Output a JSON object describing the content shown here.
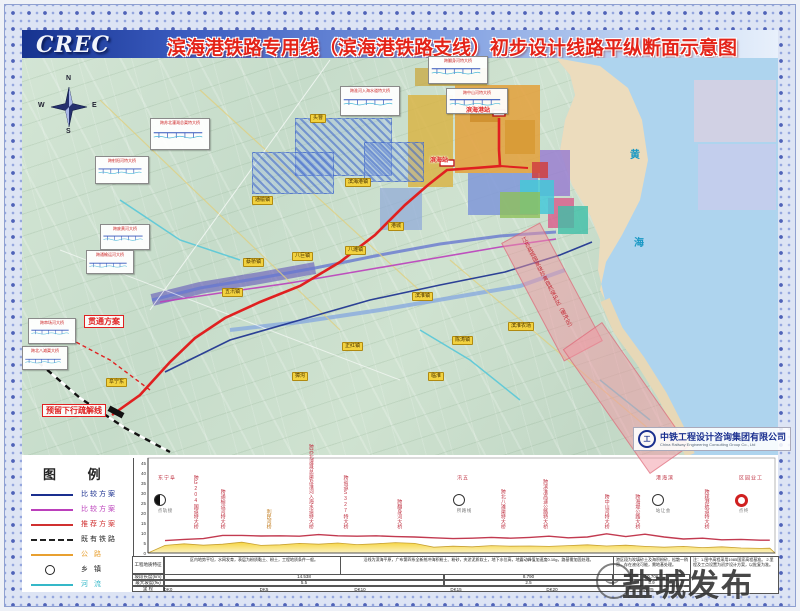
{
  "title_bar": {
    "logo": "CREC",
    "title": "滨海港铁路专用线（滨海港铁路支线）初步设计线路平纵断面示意图"
  },
  "map": {
    "sea_chars": [
      {
        "t": "黄",
        "x": 630,
        "y": 146
      },
      {
        "t": "海",
        "x": 634,
        "y": 234
      }
    ],
    "compass": {
      "n": "N",
      "w": "W",
      "e": "E",
      "s": "S"
    },
    "scheme_labels": [
      {
        "t": "贯通方案",
        "x": 84,
        "y": 315
      },
      {
        "t": "预留下行疏解线",
        "x": 42,
        "y": 404
      }
    ],
    "station_labels": [
      {
        "t": "滨海站",
        "x": 430,
        "y": 155
      },
      {
        "t": "滨海港站",
        "x": 466,
        "y": 105
      }
    ],
    "town_labels": [
      {
        "t": "头罾",
        "x": 310,
        "y": 114
      },
      {
        "t": "滨海港镇",
        "x": 345,
        "y": 178
      },
      {
        "t": "港城",
        "x": 388,
        "y": 222
      },
      {
        "t": "通榆镇",
        "x": 252,
        "y": 196
      },
      {
        "t": "八巨镇",
        "x": 292,
        "y": 252
      },
      {
        "t": "蔡桥镇",
        "x": 243,
        "y": 258
      },
      {
        "t": "五汛镇",
        "x": 222,
        "y": 288
      },
      {
        "t": "八滩镇",
        "x": 345,
        "y": 246
      },
      {
        "t": "滨淮镇",
        "x": 412,
        "y": 292
      },
      {
        "t": "正红镇",
        "x": 342,
        "y": 342
      },
      {
        "t": "陈涛镇",
        "x": 452,
        "y": 336
      },
      {
        "t": "滨淮农场",
        "x": 508,
        "y": 322
      },
      {
        "t": "獐沟",
        "x": 292,
        "y": 372
      },
      {
        "t": "临淮",
        "x": 428,
        "y": 372
      },
      {
        "t": "阜宁东",
        "x": 106,
        "y": 378
      }
    ],
    "callouts": [
      {
        "t": "跨射阳河特大桥",
        "x": 95,
        "y": 156,
        "w": 50,
        "h": 24
      },
      {
        "t": "跨苏北灌溉总渠特大桥",
        "x": 150,
        "y": 118,
        "w": 56,
        "h": 28
      },
      {
        "t": "跨淮河入海水道特大桥",
        "x": 340,
        "y": 86,
        "w": 56,
        "h": 26
      },
      {
        "t": "跨翻身河特大桥",
        "x": 428,
        "y": 56,
        "w": 56,
        "h": 24
      },
      {
        "t": "跨中山河特大桥",
        "x": 446,
        "y": 88,
        "w": 58,
        "h": 22
      },
      {
        "t": "跨废黄河大桥",
        "x": 100,
        "y": 224,
        "w": 46,
        "h": 22
      },
      {
        "t": "跨通榆运河大桥",
        "x": 86,
        "y": 250,
        "w": 44,
        "h": 20
      },
      {
        "t": "跨串场河大桥",
        "x": 28,
        "y": 318,
        "w": 44,
        "h": 22
      },
      {
        "t": "跨北八滩渠大桥",
        "x": 22,
        "y": 346,
        "w": 42,
        "h": 20
      }
    ],
    "reserve_text": "江苏盐城国家级珍禽自然保护区（缓冲区）",
    "credit": {
      "company": "中铁工程设计咨询集团有限公司",
      "company_en": "China Railway Engineering Consulting Group Co., Ltd",
      "logo_glyph": "工"
    }
  },
  "legend": {
    "title": "图  例",
    "items": [
      {
        "label": "比较方案",
        "color": "#1a2f8f",
        "style": "solid"
      },
      {
        "label": "比较方案",
        "color": "#bb3fbb",
        "style": "solid"
      },
      {
        "label": "推荐方案",
        "color": "#d03030",
        "style": "solid"
      },
      {
        "label": "既有铁路",
        "color": "#222222",
        "style": "dashed"
      },
      {
        "label": "公  路",
        "color": "#e8a030",
        "style": "solid"
      },
      {
        "label": "乡  镇",
        "color": "#222222",
        "style": "circle"
      },
      {
        "label": "河  流",
        "color": "#35b8c8",
        "style": "solid"
      }
    ]
  },
  "profile": {
    "y_ticks": [
      45,
      40,
      35,
      30,
      25,
      20,
      15,
      10,
      5,
      0
    ],
    "annotations": [
      {
        "km": 1.6,
        "t": "跨G204国道特大桥"
      },
      {
        "km": 3.0,
        "t": "跨通榆运河特大桥"
      },
      {
        "km": 5.4,
        "t": "利民河桥",
        "c": "#c07818"
      },
      {
        "km": 7.6,
        "t": "跨苏北灌溉总渠及淮河入海水道特大桥"
      },
      {
        "km": 9.4,
        "t": "跨省道S327特大桥"
      },
      {
        "km": 12.2,
        "t": "跨翻身河大桥"
      },
      {
        "km": 17.6,
        "t": "跨北八滩渠特大桥"
      },
      {
        "km": 19.8,
        "t": "跨滨淮高速公路特大桥"
      },
      {
        "km": 23.0,
        "t": "跨中山河特大桥"
      },
      {
        "km": 24.6,
        "t": "跨海堤公路大桥"
      },
      {
        "km": 28.2,
        "t": "跨疏港航道特大桥"
      }
    ],
    "stations": [
      {
        "x": 160,
        "name": "阜宁东",
        "sub": "接轨点",
        "type": "half"
      },
      {
        "x": 459,
        "name": "五汛",
        "sub": "线路所",
        "type": "white"
      },
      {
        "x": 658,
        "name": "滨海港",
        "sub": "会让站",
        "type": "white"
      },
      {
        "x": 741,
        "name": "工业园区",
        "sub": "终点",
        "type": "red"
      }
    ],
    "table": {
      "row_labels": [
        "工程地质特征",
        "坡段长度(km)",
        "最大坡度(‰)",
        "里  程"
      ],
      "geology_cells": [
        "区内地势平坦，水网发育，表层为粉质黏土、粉土，工程地质条件一般。",
        "沿线为滨海平原，广布第四系全新统冲海积粉土、粉砂，夹淤泥质软土，地下水位高，地震动峰值加速度0.10g，路基需加固处理。",
        "港区段为吹填砂土及海积粉砂，松散～稍密，存在液化可能，需地基处理。"
      ],
      "sections": [
        {
          "len": "14.538",
          "grade": "5.5"
        },
        {
          "len": "8.790",
          "grade": "2.5"
        },
        {
          "len": "10.706",
          "grade": "5.9"
        }
      ],
      "mileage": [
        {
          "x": 168,
          "t": "DK0"
        },
        {
          "x": 264,
          "t": "DK5"
        },
        {
          "x": 360,
          "t": "DK10"
        },
        {
          "x": 456,
          "t": "DK15"
        },
        {
          "x": 552,
          "t": "DK20"
        },
        {
          "x": 648,
          "t": "DK25"
        }
      ]
    },
    "note": "注：1.图中高程采用1985国家高程基准。 2.里程及工点设置为初步设计方案，以批复为准。"
  },
  "watermark": "盐城发布",
  "chart_data": {
    "type": "line",
    "title": "线路纵断面示意",
    "xlabel": "里程 DK (km)",
    "ylabel": "高程 (m)",
    "x_range_km": [
      0,
      31.5
    ],
    "ylim": [
      0,
      45
    ],
    "legend_position": "none",
    "grid": false,
    "series": [
      {
        "name": "设计线(推荐方案)",
        "x": [
          0,
          1,
          2,
          3,
          4,
          5,
          6,
          7,
          8,
          9,
          10,
          11,
          12,
          13,
          14,
          15,
          16,
          17,
          18,
          19,
          20,
          21,
          22,
          23,
          24,
          25,
          26,
          27,
          28,
          29,
          30,
          31,
          31.5
        ],
        "values": [
          6.2,
          6.8,
          7.2,
          8.8,
          8.8,
          8.5,
          8.6,
          8.4,
          9.2,
          8.6,
          8.4,
          8.6,
          8.2,
          8.0,
          7.6,
          7.2,
          7.4,
          7.8,
          7.4,
          7.8,
          8.4,
          7.6,
          8.0,
          9.6,
          8.2,
          9.4,
          8.0,
          7.0,
          7.4,
          6.6,
          6.8,
          6.4,
          6.4
        ]
      },
      {
        "name": "地面线",
        "x": [
          0,
          1,
          2,
          3,
          4,
          5,
          6,
          7,
          8,
          9,
          10,
          11,
          12,
          13,
          14,
          15,
          16,
          17,
          18,
          19,
          20,
          21,
          22,
          23,
          24,
          25,
          26,
          27,
          28,
          29,
          30,
          31,
          31.5
        ],
        "values": [
          3.8,
          4.6,
          3.9,
          4.4,
          5.4,
          3.8,
          4.1,
          4.8,
          4.4,
          5.0,
          4.2,
          4.6,
          5.2,
          4.8,
          2.9,
          3.4,
          3.1,
          3.7,
          3.4,
          3.5,
          3.3,
          3.7,
          4.1,
          3.5,
          3.9,
          3.3,
          2.9,
          3.3,
          2.7,
          3.1,
          2.5,
          2.3,
          2.4
        ]
      }
    ],
    "sections": [
      {
        "length_km": 14.538,
        "max_grade_permille": 5.5
      },
      {
        "length_km": 8.79,
        "max_grade_permille": 2.5
      },
      {
        "length_km": 10.706,
        "max_grade_permille": 5.9
      }
    ]
  }
}
